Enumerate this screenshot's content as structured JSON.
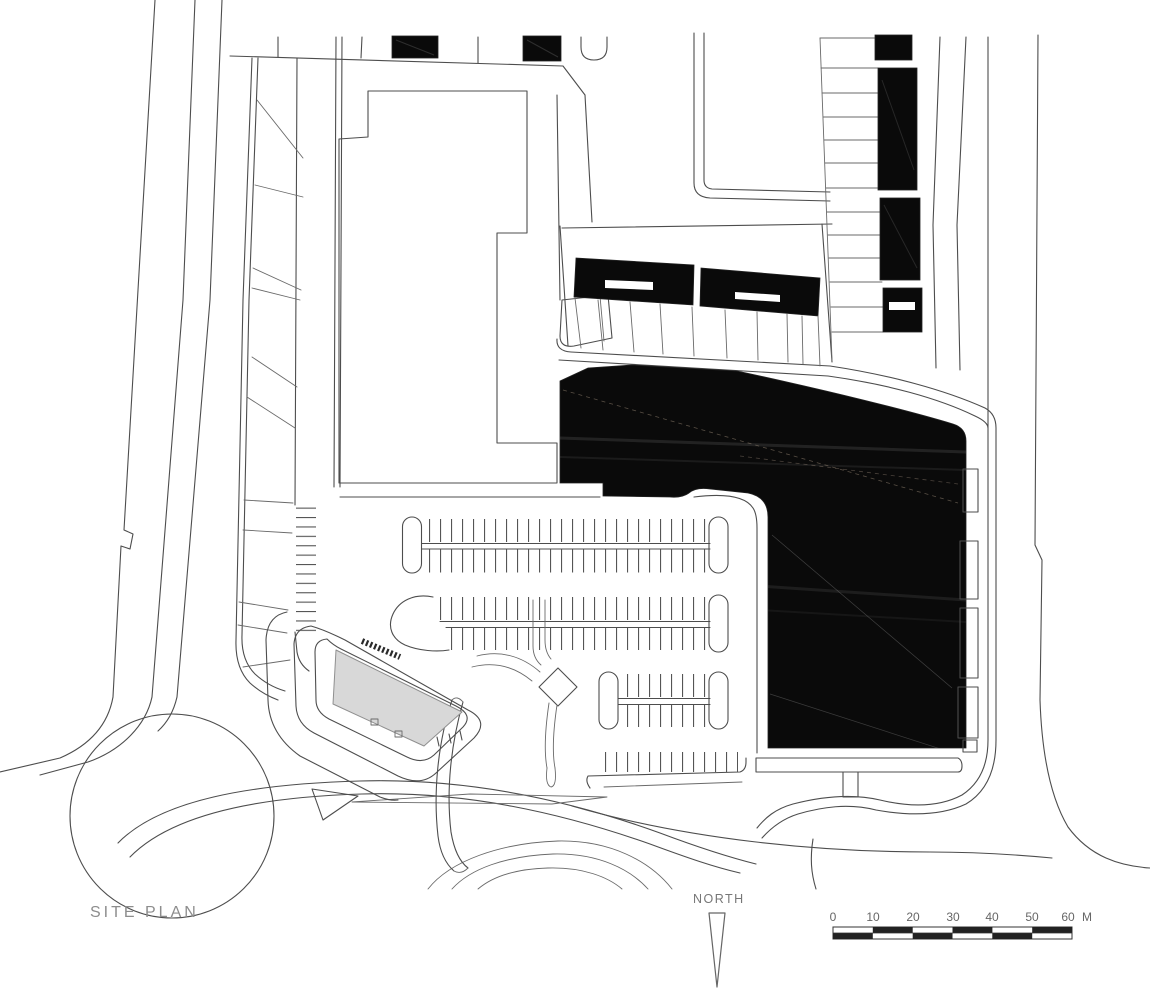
{
  "page": {
    "title": "SITE PLAN"
  },
  "north": {
    "label": "NORTH"
  },
  "scale_bar": {
    "unit": "M",
    "ticks": [
      "0",
      "10",
      "20",
      "30",
      "40",
      "50",
      "60"
    ]
  },
  "colors": {
    "building_fill": "#0a0a0a",
    "proposed_building_fill": "#d8d8d8",
    "scale_bar_fill": "#222222",
    "line": "#4d4d4d"
  }
}
